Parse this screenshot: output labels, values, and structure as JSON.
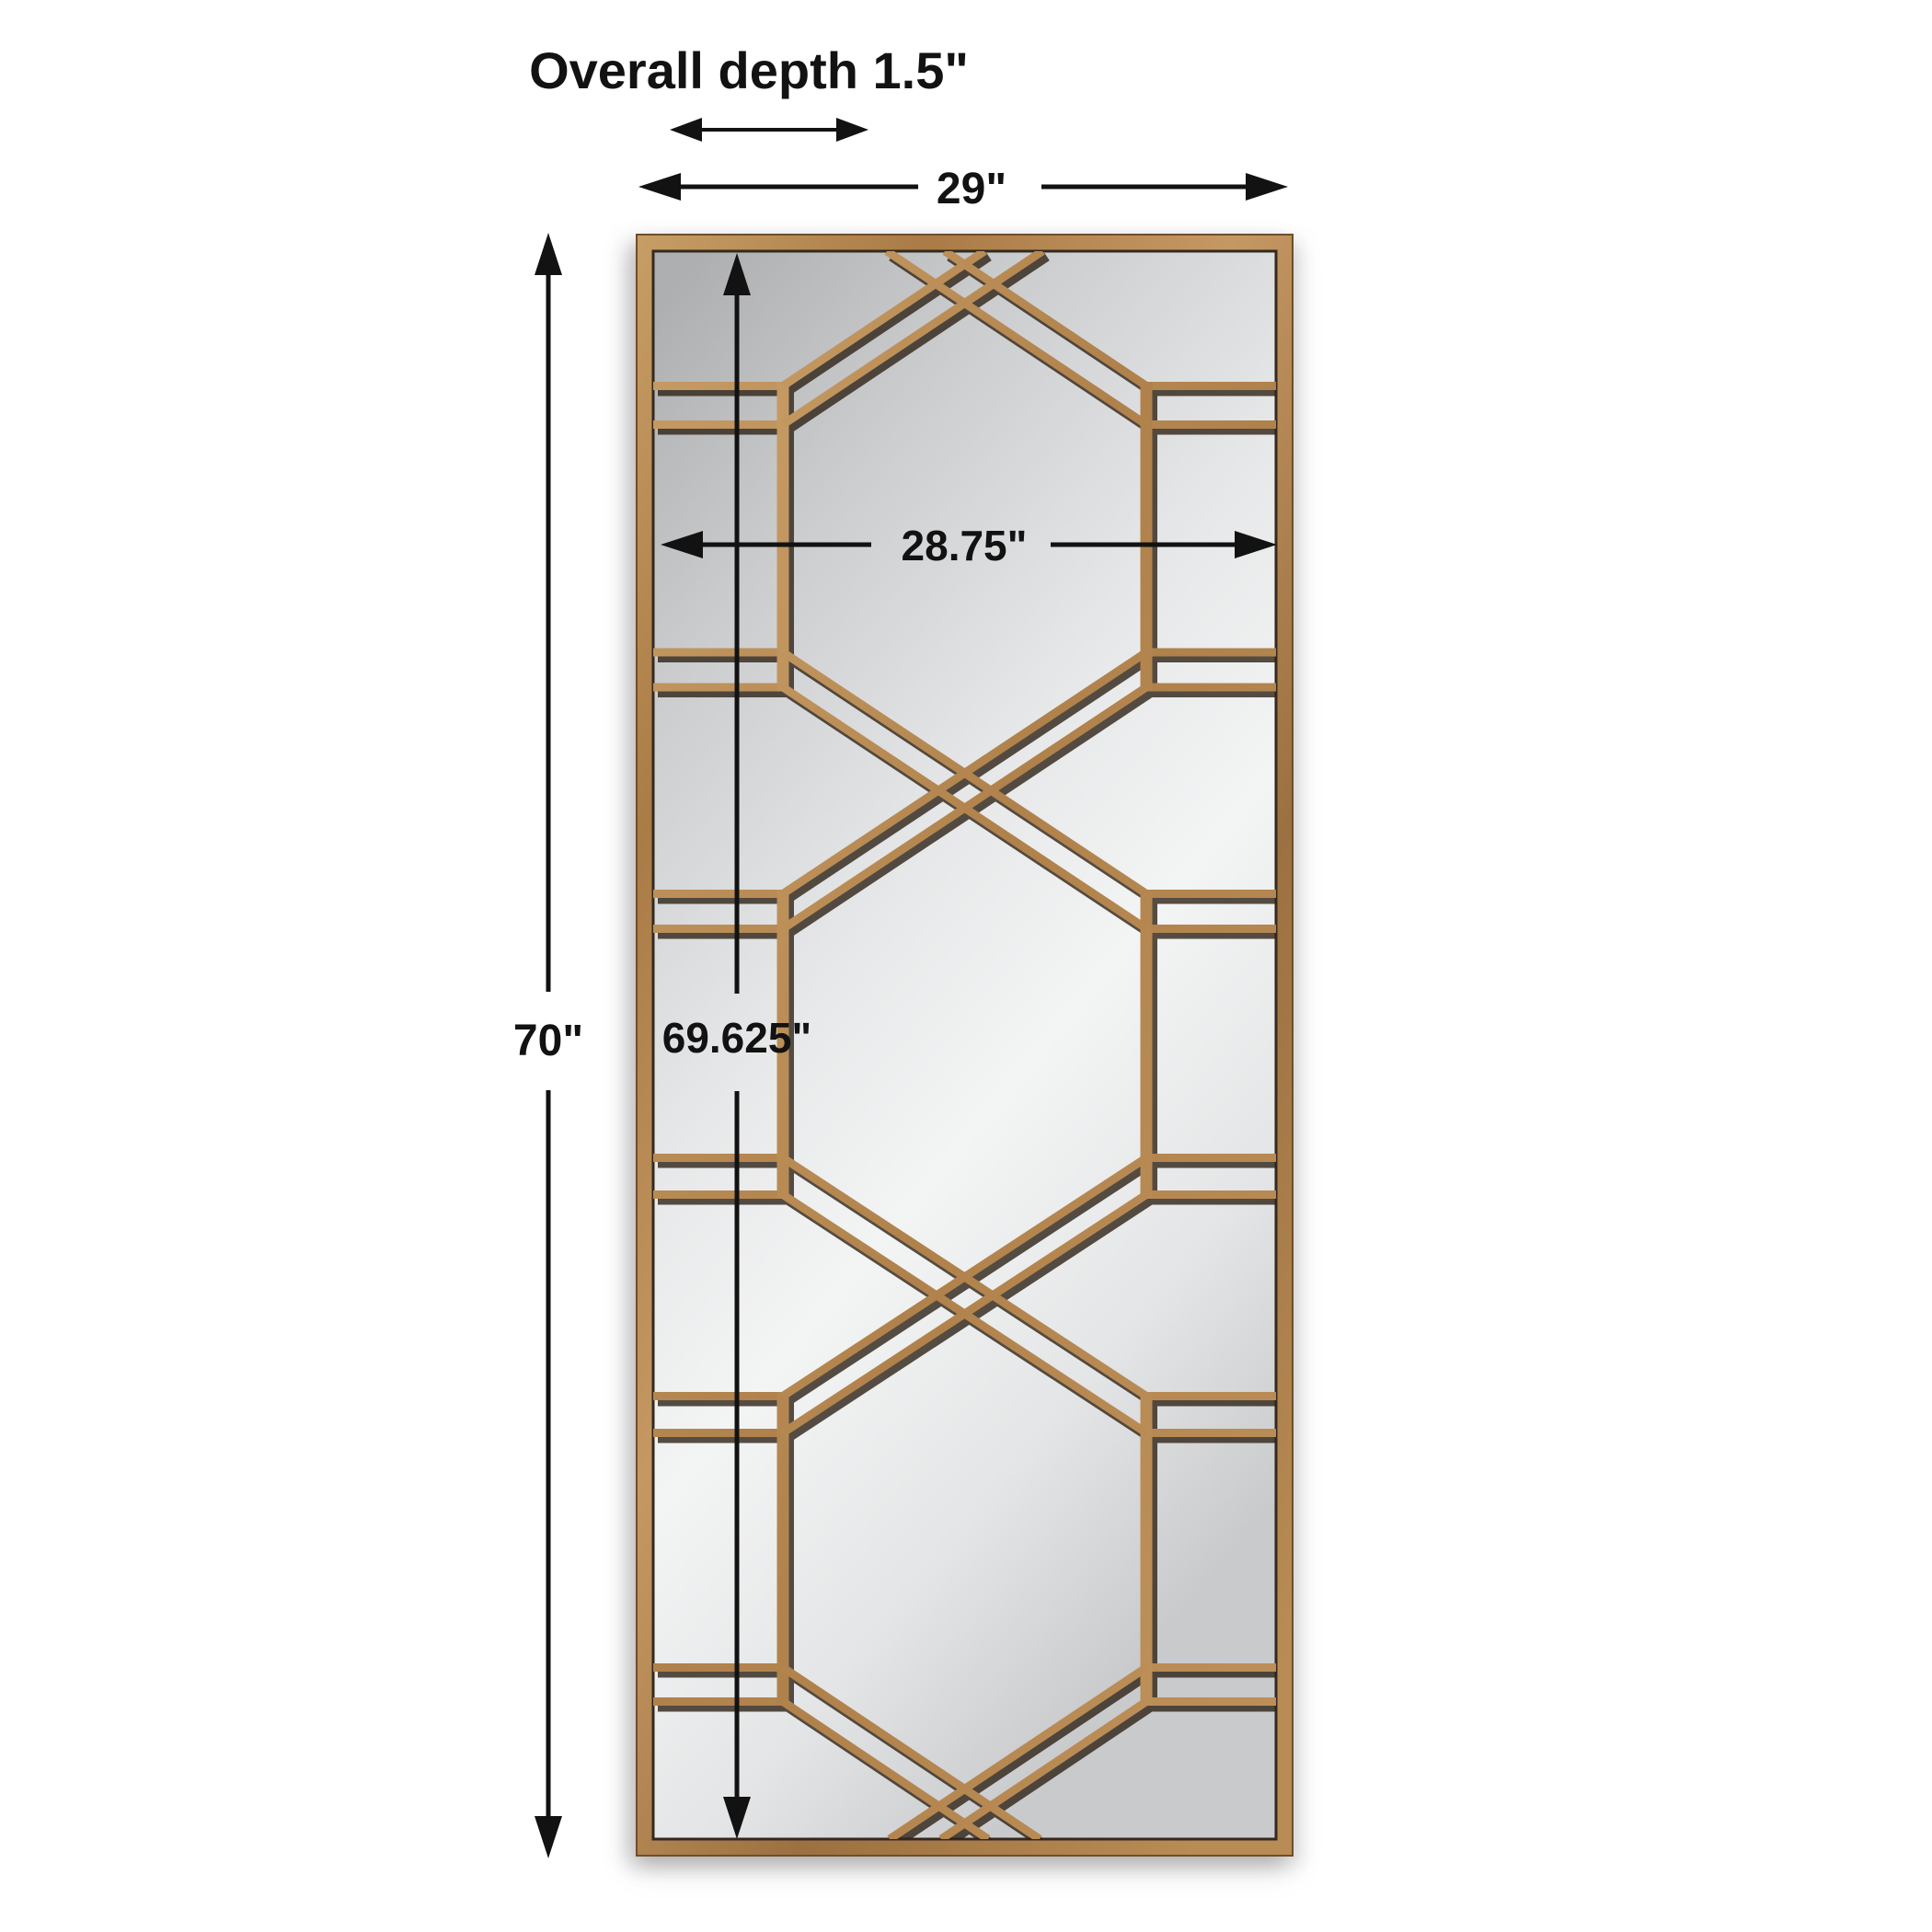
{
  "page": {
    "background_color": "#ffffff",
    "description": "Product dimension diagram of a tall rectangular gold-framed mirror with geometric fretwork overlay"
  },
  "product": {
    "name": "gold-fretwork-leaner-mirror",
    "frame_color": "#b28350",
    "fretwork_color": "#b78a52",
    "mirror_glass_color": "#e6e7e8",
    "annotation_color": "#121212"
  },
  "annotations": {
    "overall_depth": {
      "label": "Overall depth 1.5\""
    },
    "outer_width": {
      "label": "29\""
    },
    "inner_width": {
      "label": "28.75\""
    },
    "outer_height": {
      "label": "70\""
    },
    "inner_height": {
      "label": "69.625\""
    }
  }
}
